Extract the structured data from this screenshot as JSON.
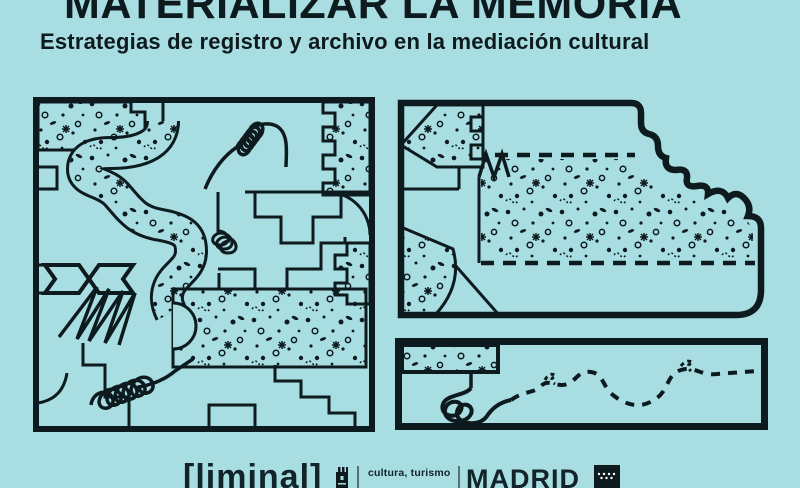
{
  "poster": {
    "title": "MATERIALIZAR LA MEMORIA",
    "subtitle": "Estrategias de registro y archivo en la mediación cultural"
  },
  "footer": {
    "liminal_logo": "[liminal]",
    "department_label": "cultura, turismo",
    "city_label": "MADRID"
  },
  "colors": {
    "background": "#a8dde2",
    "ink": "#0e1b1e"
  },
  "illustrations": {
    "left_panel": "abstract map collage with speckled regions, coils and zigzags",
    "top_right_panel": "speckled field with dashed borders and wavy outline",
    "bottom_right_panel": "coil unwinding into a dashed wandering path"
  }
}
